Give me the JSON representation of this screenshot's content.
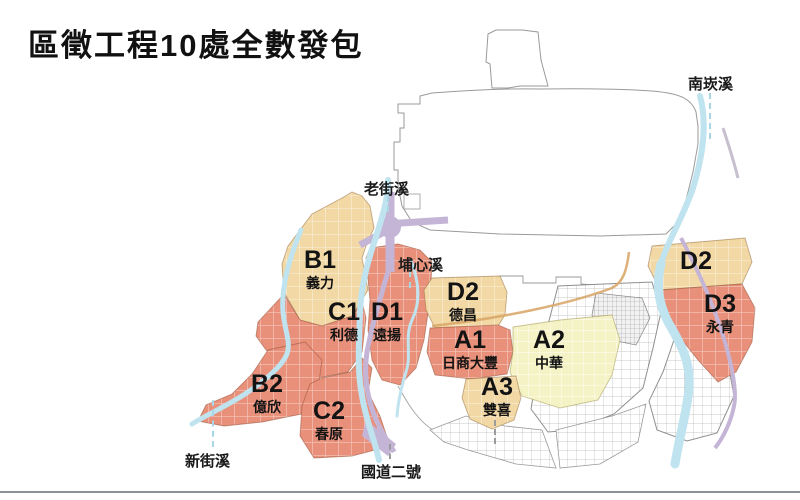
{
  "title": "區徵工程10處全數發包",
  "zones": {
    "A1": {
      "code": "A1",
      "name": "日商大豐"
    },
    "A2": {
      "code": "A2",
      "name": "中華"
    },
    "A3": {
      "code": "A3",
      "name": "雙喜"
    },
    "B1": {
      "code": "B1",
      "name": "義力"
    },
    "B2": {
      "code": "B2",
      "name": "億欣"
    },
    "C1": {
      "code": "C1",
      "name": "利德"
    },
    "C2": {
      "code": "C2",
      "name": "春原"
    },
    "D1": {
      "code": "D1",
      "name": "遠揚"
    },
    "D2_west": {
      "code": "D2",
      "name": "德昌"
    },
    "D2_east": {
      "code": "D2",
      "name": ""
    },
    "D3": {
      "code": "D3",
      "name": "永青"
    }
  },
  "map_labels": {
    "nankan_river": "南崁溪",
    "laojie_river": "老街溪",
    "puxin_river": "埔心溪",
    "xinjie_river": "新街溪",
    "national_highway_2": "國道二號"
  },
  "colors": {
    "zone_red": "#E8907A",
    "zone_beige": "#F2D8A4",
    "zone_yellow": "#F5F3C5",
    "river_blue": "#BFE3EF",
    "highway_purple": "#C4B4D6",
    "road_tan": "#D9A96A",
    "outline_gray": "#999999"
  }
}
